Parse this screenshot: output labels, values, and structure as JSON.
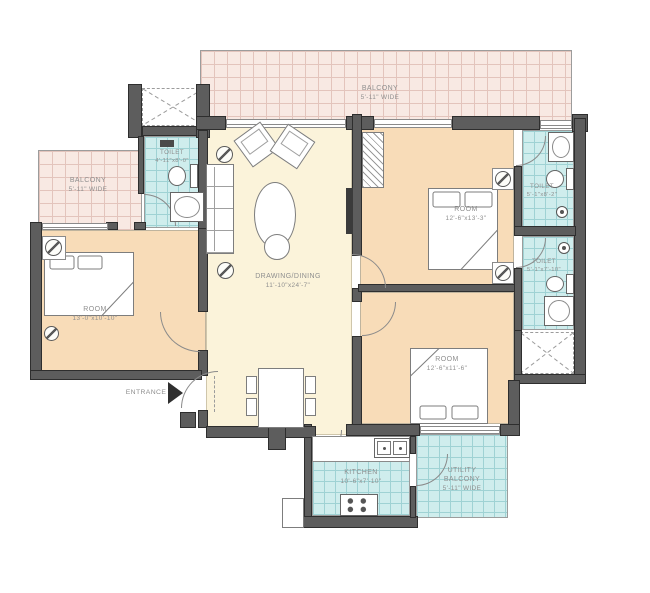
{
  "areas": {
    "balcony_top": {
      "name": "BALCONY",
      "dims": "5'-11\" WIDE"
    },
    "balcony_left": {
      "name": "BALCONY",
      "dims": "5'-11\" WIDE"
    },
    "toilet_left": {
      "name": "TOILET",
      "dims": "4'-11\"x8'-0\""
    },
    "room_left": {
      "name": "ROOM",
      "dims": "13'-0\"x10'-10\""
    },
    "drawing_dining": {
      "name": "DRAWING/DINING",
      "dims": "11'-10\"x24'-7\""
    },
    "room_top_right": {
      "name": "ROOM",
      "dims": "12'-6\"x13'-3\""
    },
    "toilet_right_upper": {
      "name": "TOILET",
      "dims": "5'-1\"x8'-2\""
    },
    "toilet_right_lower": {
      "name": "TOILET",
      "dims": "5'-1\"x7'-10\""
    },
    "room_bottom_right": {
      "name": "ROOM",
      "dims": "12'-6\"x11'-6\""
    },
    "kitchen": {
      "name": "KITCHEN",
      "dims": "10'-6\"x7'-10\""
    },
    "utility_balcony": {
      "name": "UTILITY",
      "name2": "BALCONY",
      "dims": "5'-11\" WIDE"
    }
  },
  "entrance": {
    "label": "ENTRANCE"
  },
  "colors": {
    "balcony_fill": "#f8e9e3",
    "balcony_line": "#e3c4bc",
    "wet_fill": "#cfeded",
    "wet_line": "#9fd2d4",
    "room_fill": "#f8dcb8",
    "hall_fill": "#fbf3da",
    "wall": "#5d5d5d",
    "wall_edge": "#2e2e2e",
    "label_text": "#8f8f8f",
    "line": "#8a8a8a"
  }
}
